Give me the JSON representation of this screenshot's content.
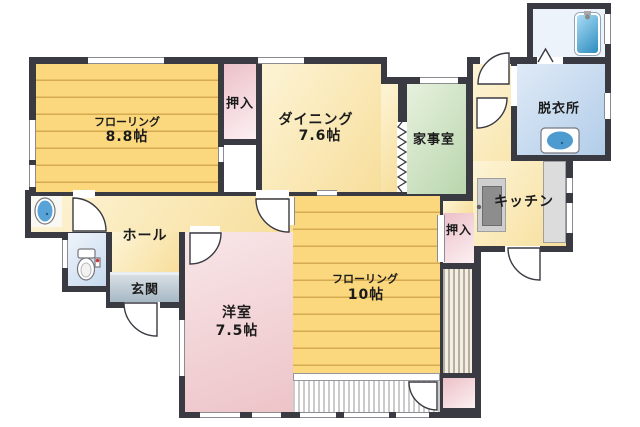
{
  "rooms": {
    "flooring_88": {
      "name": "フローリング",
      "size": "8.8帖"
    },
    "closet_top": {
      "name": "押入"
    },
    "dining": {
      "name": "ダイニング",
      "size": "7.6帖"
    },
    "kajishitsu": {
      "name": "家事室"
    },
    "datsuijo": {
      "name": "脱衣所"
    },
    "kitchen": {
      "name": "キッチン"
    },
    "closet_mid": {
      "name": "押入"
    },
    "flooring_10": {
      "name": "フローリング",
      "size": "10帖"
    },
    "yoshitsu": {
      "name": "洋室",
      "size": "7.5帖"
    },
    "hall": {
      "name": "ホール"
    },
    "genkan": {
      "name": "玄関"
    }
  },
  "fixtures": [
    "bathtub",
    "wash-basin",
    "vanity-sink",
    "toilet",
    "kitchen-sink",
    "kitchen-counter"
  ],
  "colors": {
    "wall": "#3a3a42",
    "flooring_room": "#fbd87d",
    "dining_kitchen_hall": "#f9e4a8",
    "utility_room": "#c8ddb9",
    "western_room": "#eecdd0",
    "closet": "#f0cdd4",
    "dressing_room": "#c3d6ec",
    "entrance": "#aebfcc",
    "bathtub": "#3f9acc"
  }
}
